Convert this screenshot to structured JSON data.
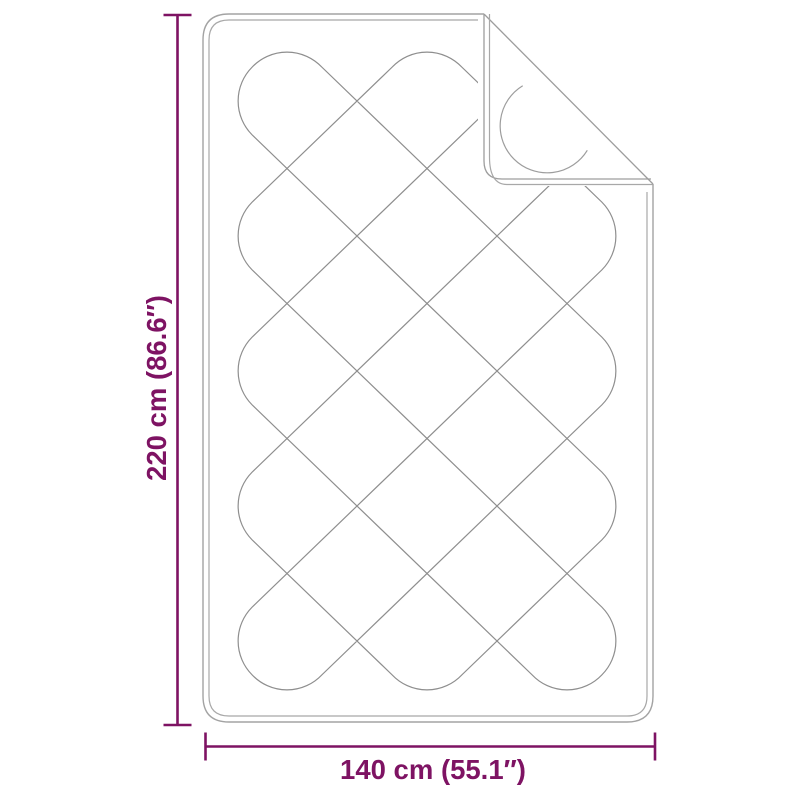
{
  "diagram": {
    "height_label": "220 cm (86.6″)",
    "width_label": "140 cm (55.1″)",
    "accent_color": "#7e1363",
    "line_color": "#9a9a9a"
  }
}
